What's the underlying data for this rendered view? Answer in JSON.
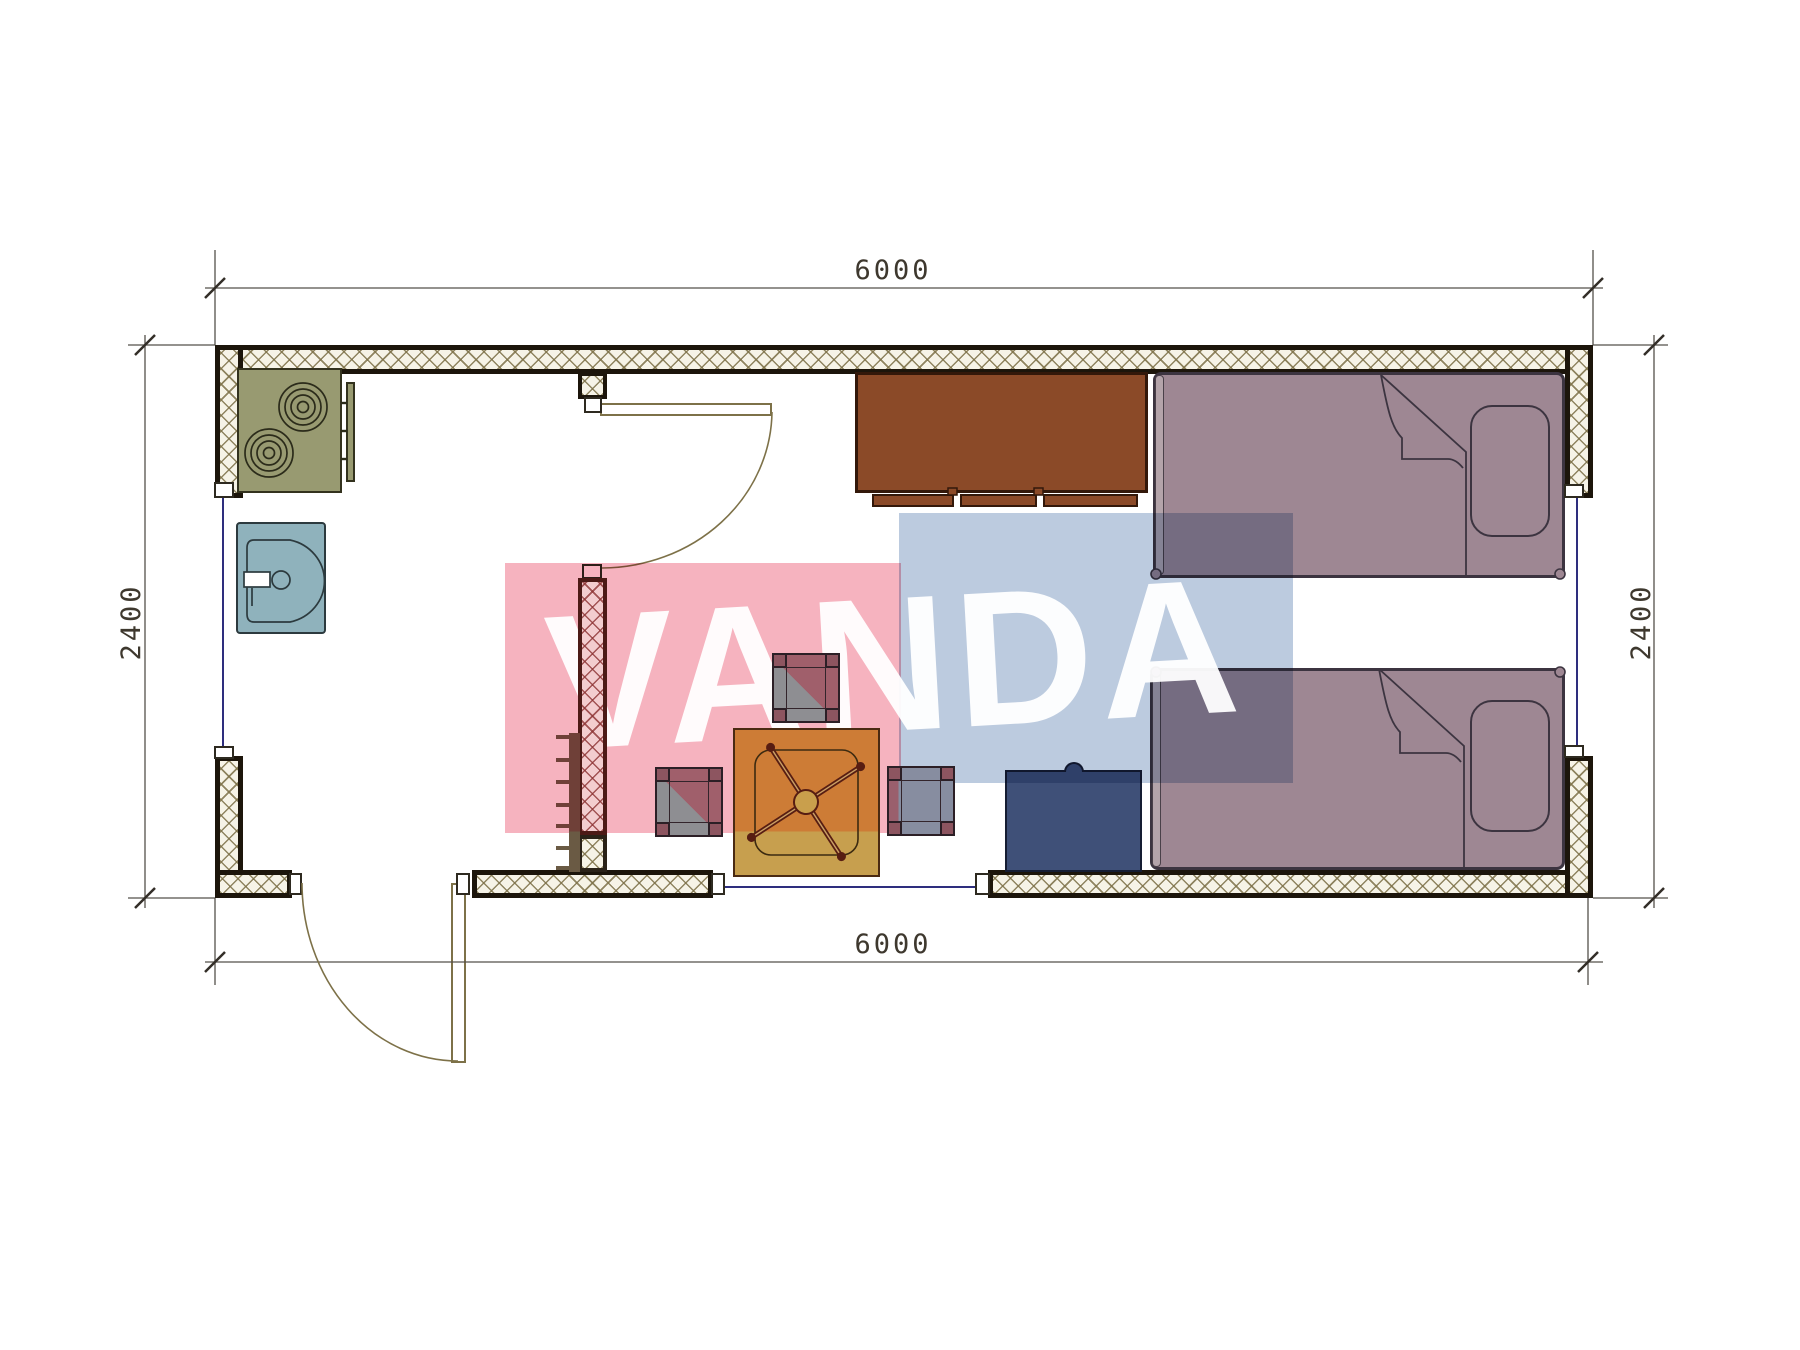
{
  "drawing": {
    "type": "architectural floor plan",
    "unit_hint": "mm",
    "dimensions": {
      "top": "6000",
      "bottom": "6000",
      "left": "2400",
      "right": "2400"
    },
    "furniture_icons": [
      "stove-icon",
      "sink-icon",
      "kitchen-counter-icon",
      "cabinet-icon",
      "bed-icon",
      "bed-icon",
      "table-icon",
      "stool-icon",
      "stool-icon",
      "stool-icon",
      "nightstand-icon",
      "coat-rack-icon",
      "door-swing-icon",
      "window-icon"
    ],
    "wall_style": "cross-hatched insulation"
  },
  "watermark": {
    "text": "VANDA",
    "pink_color": "#f6b3bf",
    "blue_color": "#bccbdf",
    "text_color": "#ffffff"
  },
  "colors": {
    "wall_outline": "#1c150b",
    "hatch_line": "#7d7148",
    "bed_fill": "#9e8793",
    "cabinet_fill": "#8b4a28",
    "stove_fill": "#989a71",
    "sink_fill": "#8fb2bc",
    "table_fill": "#c79f4e",
    "stool_fill": "#a05f6b",
    "nightstand_fill": "#3f5078",
    "window_line": "#2e2e7e",
    "dimension_text": "#3e382e"
  }
}
